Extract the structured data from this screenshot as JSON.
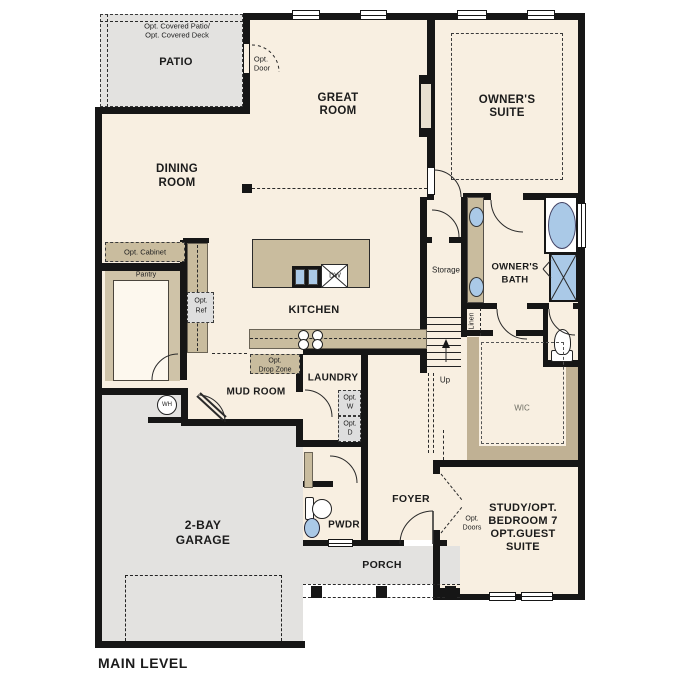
{
  "plan": {
    "title": "MAIN LEVEL",
    "patio": {
      "name": "PATIO",
      "opt1": "Opt. Covered Patio/",
      "opt2": "Opt. Covered Deck"
    },
    "opt_door": {
      "l1": "Opt.",
      "l2": "Door"
    },
    "great_room": {
      "l1": "GREAT",
      "l2": "ROOM"
    },
    "owners_suite": {
      "l1": "OWNER'S",
      "l2": "SUITE"
    },
    "dining": {
      "l1": "DINING",
      "l2": "ROOM"
    },
    "opt_cabinet": "Opt. Cabinet",
    "pantry": "Pantry",
    "opt_ref": {
      "l1": "Opt.",
      "l2": "Ref"
    },
    "kitchen": {
      "name": "KITCHEN",
      "dw": "DW"
    },
    "storage": "Storage",
    "owners_bath": {
      "l1": "OWNER'S",
      "l2": "BATH"
    },
    "linen": "Linen",
    "up": "Up",
    "wic": "WIC",
    "opt_drop": {
      "l1": "Opt.",
      "l2": "Drop Zone"
    },
    "mud_room": "MUD ROOM",
    "laundry": "LAUNDRY",
    "opt_w": {
      "l1": "Opt.",
      "l2": "W"
    },
    "opt_d": {
      "l1": "Opt.",
      "l2": "D"
    },
    "wh": "WH",
    "garage": {
      "l1": "2-BAY",
      "l2": "GARAGE"
    },
    "pwdr": "PWDR",
    "foyer": "FOYER",
    "opt_doors": {
      "l1": "Opt.",
      "l2": "Doors"
    },
    "study": {
      "l1": "STUDY/OPT.",
      "l2": "BEDROOM 7",
      "l3": "OPT.GUEST",
      "l4": "SUITE"
    },
    "porch": "PORCH"
  },
  "colors": {
    "floor": "#f8efe1",
    "hardscape": "#e3e2e0",
    "cabinet": "#c9bc9e",
    "wall": "#161616",
    "fixture_blue": "#aac9e7",
    "opt_fill": "#dedede"
  }
}
